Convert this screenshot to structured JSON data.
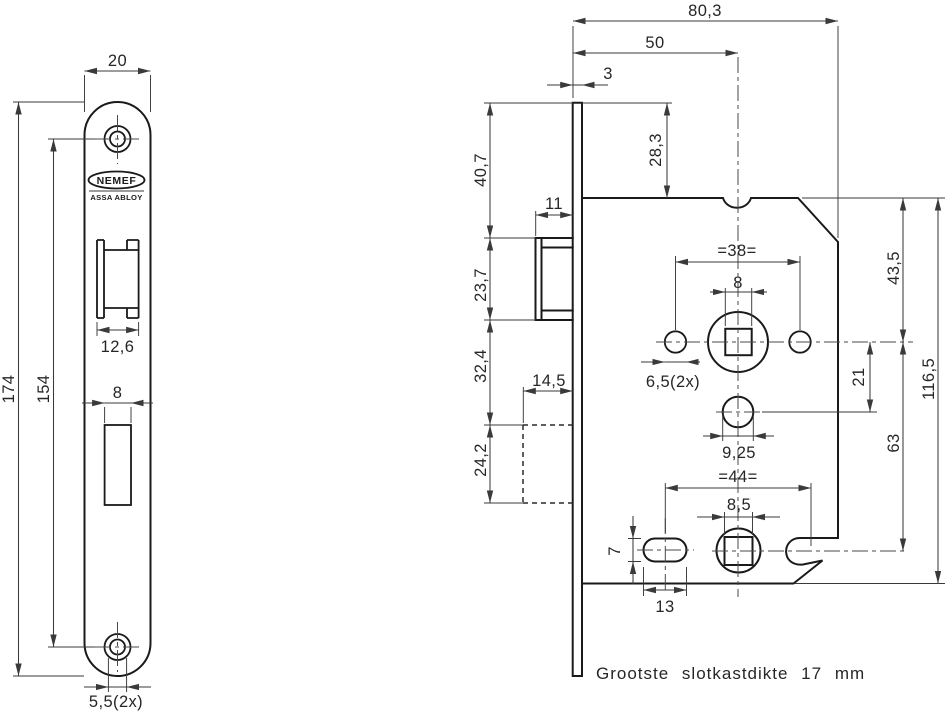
{
  "drawing": {
    "brand": {
      "logo_text": "NEMEF",
      "parent_brand": "ASSA ABLOY"
    },
    "note": "Grootste slotkastdikte 17 mm",
    "front_view": {
      "plate_width": "20",
      "plate_length": "174",
      "screw_hole_spacing": "154",
      "latch_cutout_width": "12,6",
      "deadbolt_cutout_width": "8",
      "screw_hole_diameter": "5,5(2x)"
    },
    "side_view": {
      "case_depth": "80,3",
      "backset": "50",
      "faceplate_thickness": "3",
      "plate_top_to_case": "28,3",
      "plate_top_to_latch": "40,7",
      "latch_height": "23,7",
      "latch_to_deadbolt": "32,4",
      "deadbolt_height": "24,2",
      "latch_protrusion": "11",
      "deadbolt_protrusion": "14,5",
      "screw_spacing": "=38=",
      "spindle_hole": "8",
      "screw_hole_diameter": "6,5(2x)",
      "case_top_to_spindle": "43,5",
      "spindle_to_cylinder": "21",
      "cylinder_diameter": "9,25",
      "spindle_to_lower_spindle": "63",
      "case_height": "116,5",
      "lower_spacing": "=44=",
      "lower_spindle_hole": "8,5",
      "slot_height": "7",
      "slot_width": "13"
    }
  }
}
